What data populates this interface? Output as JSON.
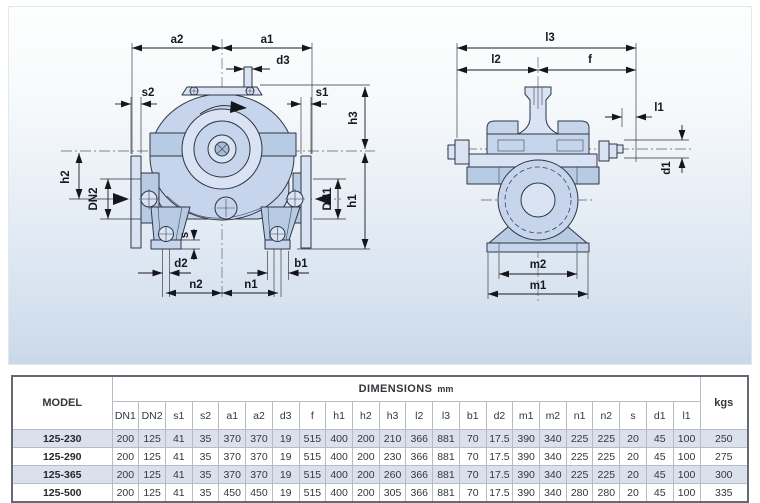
{
  "labels": {
    "a1": "a1",
    "a2": "a2",
    "d3": "d3",
    "s1": "s1",
    "s2": "s2",
    "h1": "h1",
    "h2": "h2",
    "h3": "h3",
    "dn1": "DN1",
    "dn2": "DN2",
    "s": "s",
    "d2": "d2",
    "b1": "b1",
    "n1": "n1",
    "n2": "n2",
    "l1": "l1",
    "l2": "l2",
    "l3": "l3",
    "f": "f",
    "d1": "d1",
    "m1": "m1",
    "m2": "m2"
  },
  "table": {
    "model_header": "MODEL",
    "dimensions_header": "DIMENSIONS",
    "unit": "mm",
    "kgs_header": "kgs",
    "columns": [
      "DN1",
      "DN2",
      "s1",
      "s2",
      "a1",
      "a2",
      "d3",
      "f",
      "h1",
      "h2",
      "h3",
      "l2",
      "l3",
      "b1",
      "d2",
      "m1",
      "m2",
      "n1",
      "n2",
      "s",
      "d1",
      "l1"
    ],
    "rows": [
      {
        "model": "125-230",
        "values": [
          200,
          125,
          41,
          35,
          370,
          370,
          19,
          515,
          400,
          200,
          210,
          366,
          881,
          70,
          17.5,
          390,
          340,
          225,
          225,
          20,
          45,
          100
        ],
        "kgs": 250
      },
      {
        "model": "125-290",
        "values": [
          200,
          125,
          41,
          35,
          370,
          370,
          19,
          515,
          400,
          200,
          230,
          366,
          881,
          70,
          17.5,
          390,
          340,
          225,
          225,
          20,
          45,
          100
        ],
        "kgs": 275
      },
      {
        "model": "125-365",
        "values": [
          200,
          125,
          41,
          35,
          370,
          370,
          19,
          515,
          400,
          200,
          260,
          366,
          881,
          70,
          17.5,
          390,
          340,
          225,
          225,
          20,
          45,
          100
        ],
        "kgs": 300
      },
      {
        "model": "125-500",
        "values": [
          200,
          125,
          41,
          35,
          450,
          450,
          19,
          515,
          400,
          200,
          305,
          366,
          881,
          70,
          17.5,
          390,
          340,
          280,
          280,
          20,
          45,
          100
        ],
        "kgs": 335
      }
    ]
  },
  "colors": {
    "pump_fill": "#c6d5eb",
    "pump_fill_light": "#d9e3f3",
    "pump_fill_mid": "#b8cbe5",
    "outline": "#2e3644",
    "panel_gradient_bottom": "#c9d8e9",
    "row_stripe": "#dbe1ec",
    "table_border": "#646b74"
  }
}
